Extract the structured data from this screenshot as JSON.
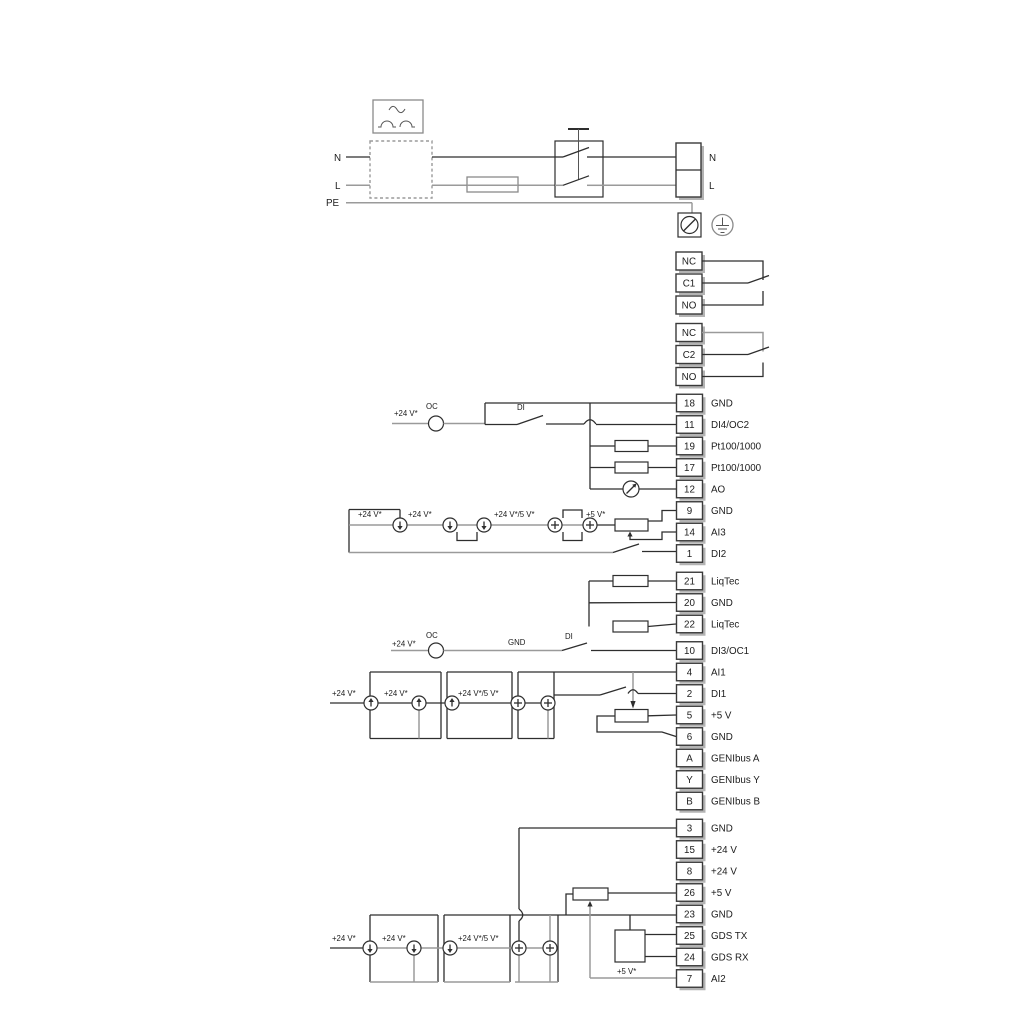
{
  "power": {
    "source_n": "N",
    "source_l": "L",
    "source_pe": "PE",
    "terminal_n": "N",
    "terminal_l": "L"
  },
  "relay1": [
    "NC",
    "C1",
    "NO"
  ],
  "relay2": [
    "NC",
    "C2",
    "NO"
  ],
  "terminals": {
    "a": [
      {
        "id": "18",
        "label": "GND"
      },
      {
        "id": "11",
        "label": "DI4/OC2"
      },
      {
        "id": "19",
        "label": "Pt100/1000"
      },
      {
        "id": "17",
        "label": "Pt100/1000"
      },
      {
        "id": "12",
        "label": "AO"
      },
      {
        "id": "9",
        "label": "GND"
      },
      {
        "id": "14",
        "label": "AI3"
      },
      {
        "id": "1",
        "label": "DI2"
      }
    ],
    "b": [
      {
        "id": "21",
        "label": "LiqTec"
      },
      {
        "id": "20",
        "label": "GND"
      },
      {
        "id": "22",
        "label": "LiqTec"
      }
    ],
    "c": [
      {
        "id": "10",
        "label": "DI3/OC1"
      },
      {
        "id": "4",
        "label": "AI1"
      },
      {
        "id": "2",
        "label": "DI1"
      },
      {
        "id": "5",
        "label": "+5 V"
      },
      {
        "id": "6",
        "label": "GND"
      },
      {
        "id": "A",
        "label": "GENIbus A"
      },
      {
        "id": "Y",
        "label": "GENIbus Y"
      },
      {
        "id": "B",
        "label": "GENIbus B"
      }
    ],
    "d": [
      {
        "id": "3",
        "label": "GND"
      },
      {
        "id": "15",
        "label": "+24 V"
      },
      {
        "id": "8",
        "label": "+24 V"
      },
      {
        "id": "26",
        "label": "+5 V"
      },
      {
        "id": "23",
        "label": "GND"
      },
      {
        "id": "25",
        "label": "GDS TX"
      },
      {
        "id": "24",
        "label": "GDS RX"
      },
      {
        "id": "7",
        "label": "AI2"
      }
    ]
  },
  "labels": {
    "v24": "+24 V*",
    "v24v5": "+24 V*/5 V*",
    "v5": "+5 V*",
    "oc": "OC",
    "di": "DI",
    "gnd": "GND"
  }
}
